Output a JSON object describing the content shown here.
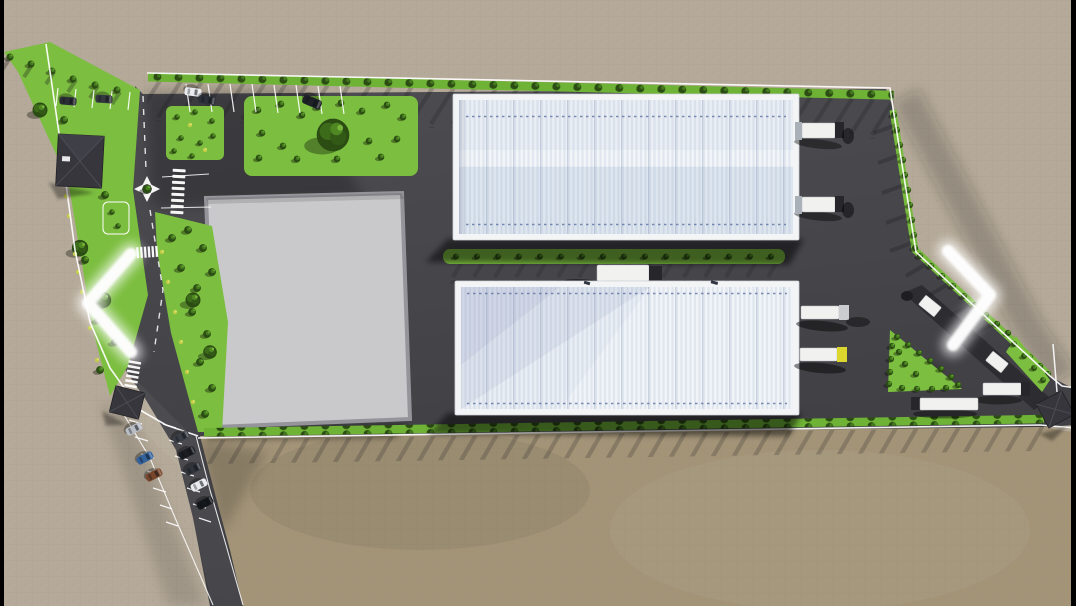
{
  "viewer": {
    "type": "image-carousel",
    "letterbox_color": "#000000",
    "nav": {
      "prev": {
        "icon": "chevron-left",
        "color": "#ffffff"
      },
      "next": {
        "icon": "chevron-right",
        "color": "#ffffff"
      }
    }
  },
  "scene": {
    "description": "Aerial top-down 3D architectural rendering of an industrial logistics site plan",
    "palette": {
      "letterbox": "#000000",
      "tan": "#b5aa99",
      "field": "#a39478",
      "asphalt": "#47474b",
      "pad": "#c9c9cc",
      "grass": "#7cbe40",
      "bush": "#2b4c13",
      "wall": "#f3f4f6",
      "roof_light": "#eaeef5",
      "roof_blue": "#dde5ef",
      "truck": "#f1f1ef",
      "cab_yellow": "#ddd62e",
      "arrow": "#ffffff"
    },
    "site": {
      "warehouses": 2,
      "concrete_pads": 1,
      "gatehouses": 3,
      "roundabouts": 1,
      "crosswalks": 3,
      "trucks": 9,
      "parked_cars": 13,
      "green_areas": [
        "west belt",
        "roadside strip",
        "two landscaped patches",
        "median strip",
        "triangular island",
        "perimeter hedges"
      ],
      "undeveloped_field": true
    }
  }
}
